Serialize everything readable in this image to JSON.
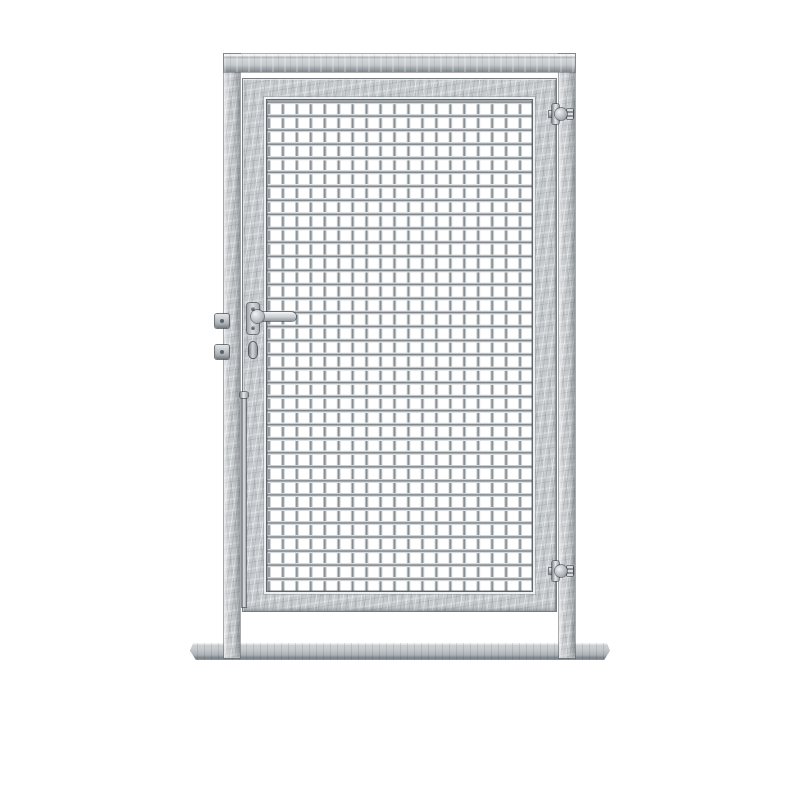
{
  "scene": {
    "type": "product-photo",
    "subject": "Galvanized steel single-leaf wire-mesh garden gate with two square posts, top rail and flat base plate",
    "background": "#ffffff"
  },
  "palette": {
    "steel-base": "#c6cacd",
    "steel-light": "#eef0f1",
    "steel-mid": "#b4b9bd",
    "steel-shadow": "#8d9499",
    "edge-dark": "#5d6367",
    "seam-dark": "#41464a",
    "plate-base": "#c2c6c9"
  },
  "gate": {
    "leaf_count": 1,
    "mesh_grid": {
      "columns": 19,
      "rows": 35
    },
    "structure": [
      "left-post",
      "top-rail",
      "right-post",
      "base-plate"
    ],
    "hardware": [
      "lever-handle",
      "handle-backplate",
      "cylinder-keyhole",
      "lock-keep-upper",
      "lock-keep-lower",
      "hinge-upper",
      "hinge-lower",
      "drop-rod"
    ]
  }
}
